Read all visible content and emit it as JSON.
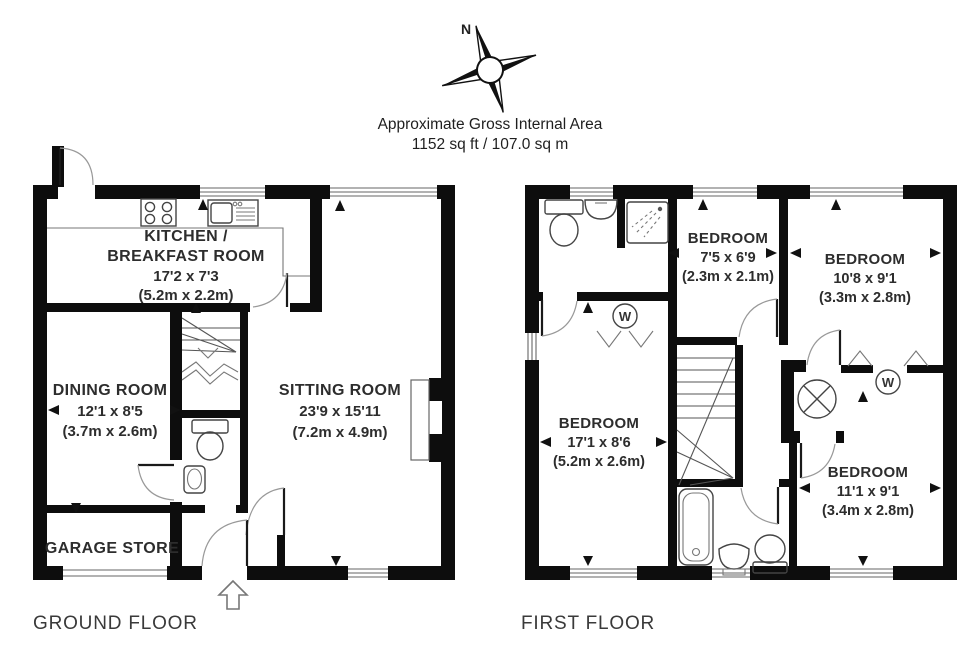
{
  "header": {
    "compass_label": "N",
    "title": "Approximate Gross Internal Area",
    "area_line": "1152 sq ft / 107.0 sq m"
  },
  "ground_floor": {
    "label": "GROUND FLOOR",
    "kitchen": {
      "name_line1": "KITCHEN /",
      "name_line2": "BREAKFAST ROOM",
      "imperial": "17'2 x 7'3",
      "metric": "(5.2m x 2.2m)"
    },
    "dining": {
      "name": "DINING ROOM",
      "imperial": "12'1 x 8'5",
      "metric": "(3.7m x 2.6m)"
    },
    "sitting": {
      "name": "SITTING ROOM",
      "imperial": "23'9 x 15'11",
      "metric": "(7.2m x 4.9m)"
    },
    "garage": {
      "name": "GARAGE STORE"
    }
  },
  "first_floor": {
    "label": "FIRST FLOOR",
    "wardrobe_symbol": "W",
    "bedroom_small": {
      "name": "BEDROOM",
      "imperial": "7'5 x 6'9",
      "metric": "(2.3m x 2.1m)"
    },
    "bedroom_rear": {
      "name": "BEDROOM",
      "imperial": "10'8 x 9'1",
      "metric": "(3.3m x 2.8m)"
    },
    "bedroom_main": {
      "name": "BEDROOM",
      "imperial": "17'1 x 8'6",
      "metric": "(5.2m x 2.6m)"
    },
    "bedroom_front": {
      "name": "BEDROOM",
      "imperial": "11'1 x 9'1",
      "metric": "(3.4m x 2.8m)"
    }
  }
}
